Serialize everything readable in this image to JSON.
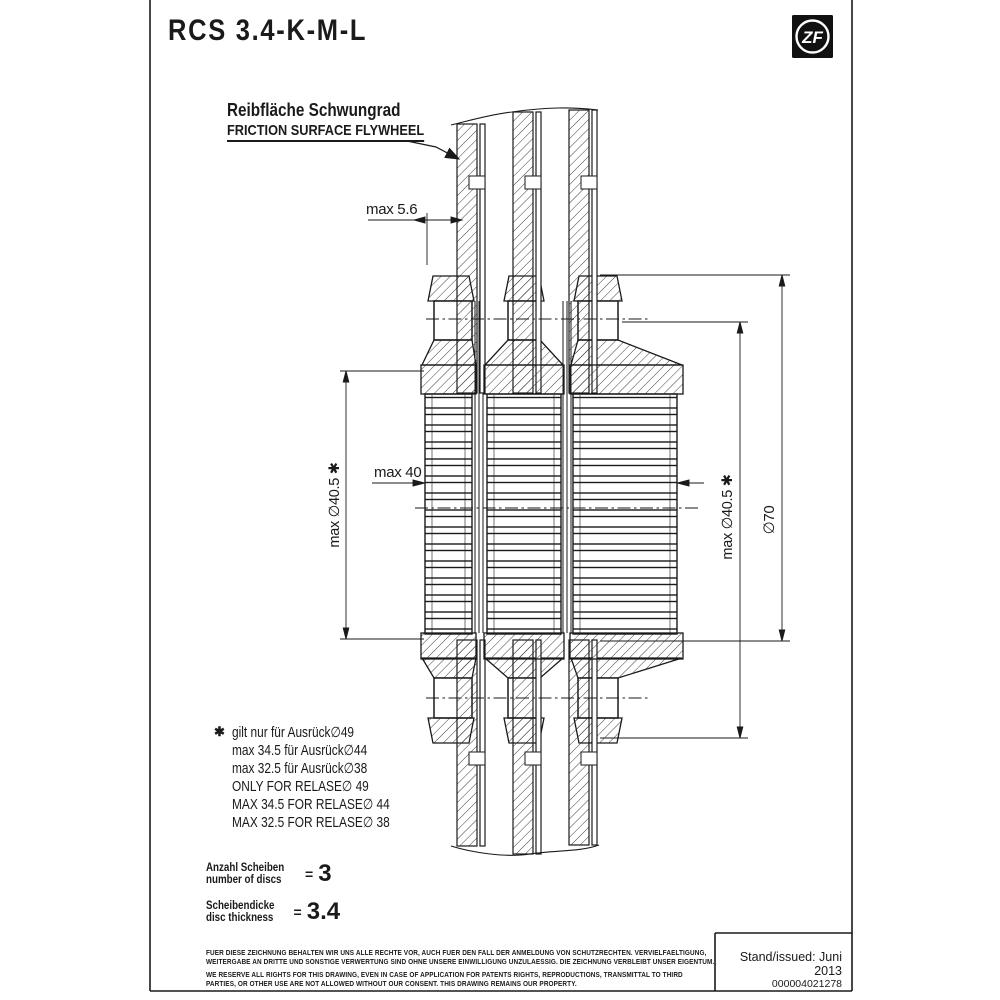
{
  "sheet": {
    "title": "RCS 3.4-K-M-L",
    "logo_text": "ZF",
    "issued": "Stand/issued: Juni 2013",
    "doc_number": "000004021278"
  },
  "callout": {
    "line_de": "Reibfläche Schwungrad",
    "line_en": "FRICTION SURFACE FLYWHEEL"
  },
  "dimensions": {
    "flywheel_gap": "max 5.6",
    "pack_width": "max 40",
    "hub_dia_left": "max ∅40.5 ✱",
    "hub_dia_right": "max ∅40.5 ✱",
    "outer_dia": "∅70"
  },
  "footnote": {
    "marker": "✱",
    "lines": [
      "gilt nur für Ausrück∅49",
      "max 34.5 für Ausrück∅44",
      "max 32.5 für Ausrück∅38",
      "ONLY FOR RELASE∅  49",
      "MAX 34.5 FOR RELASE∅  44",
      "MAX 32.5 FOR RELASE∅  38"
    ]
  },
  "specs": {
    "discs": {
      "de": "Anzahl Scheiben",
      "en": "number of discs",
      "eq": "=",
      "value": "3"
    },
    "thickness": {
      "de": "Scheibendicke",
      "en": "disc thickness",
      "eq": "=",
      "value": "3.4"
    }
  },
  "disclaimer": {
    "de1": "FUER DIESE ZEICHNUNG BEHALTEN WIR UNS ALLE RECHTE VOR, AUCH FUER DEN FALL DER ANMELDUNG VON SCHUTZRECHTEN. VERVIELFAELTIGUNG,",
    "de2": "WEITERGABE AN DRITTE UND SONSTIGE VERWERTUNG SIND OHNE UNSERE EINWILLIGUNG UNZULAESSIG. DIE ZEICHNUNG VERBLEIBT UNSER EIGENTUM.",
    "en1": "WE RESERVE ALL RIGHTS FOR THIS DRAWING, EVEN IN CASE OF APPLICATION FOR PATENTS RIGHTS, REPRODUCTIONS, TRANSMITTAL TO THIRD",
    "en2": "PARTIES, OR OTHER USE ARE NOT ALLOWED WITHOUT OUR CONSENT. THIS DRAWING REMAINS OUR PROPERTY."
  }
}
